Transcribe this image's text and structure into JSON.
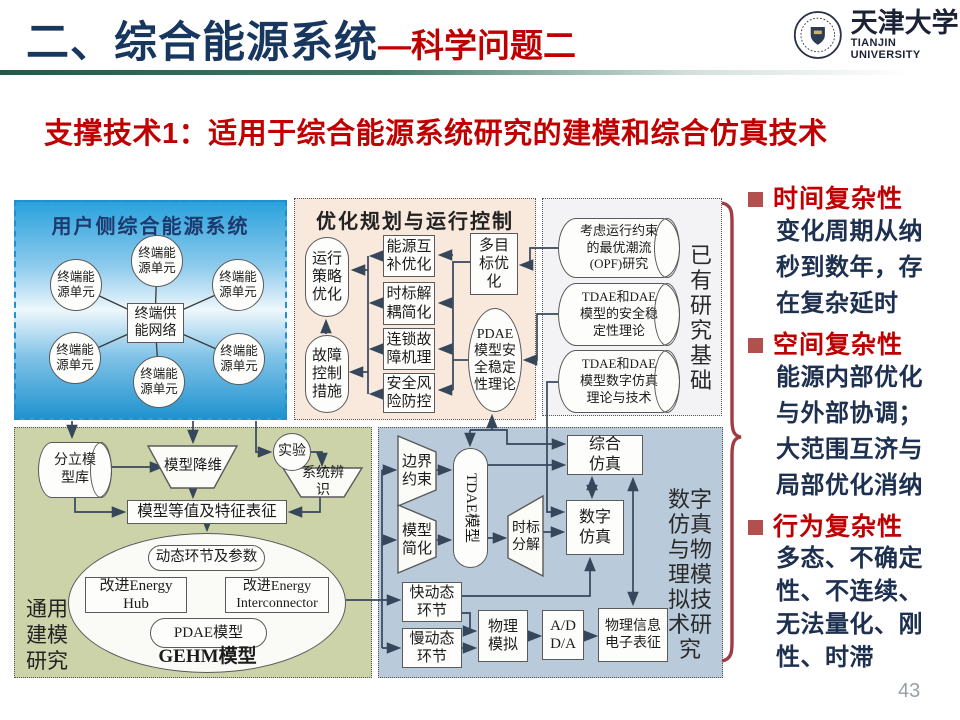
{
  "header": {
    "title": "二、综合能源系统",
    "subtitle_suffix": "—科学问题二",
    "logo_cn": "天津大学",
    "logo_en": "TIANJIN UNIVERSITY"
  },
  "lead": "支撑技术1：适用于综合能源系统研究的建模和综合仿真技术",
  "page_number": "43",
  "colors": {
    "title_navy": "#17375e",
    "accent_red": "#c00000",
    "sidebar_text": "#1e3050",
    "brace_red": "#a03c44",
    "panel_user_blue": "#2aa2dc",
    "panel_opt_pink": "#f9e8dc",
    "panel_exist_gray": "#f3f3f5",
    "panel_model_green": "#ccd3a9",
    "panel_sim_blue": "#b9cbdb"
  },
  "user_side": {
    "title": "用户侧综合能源系统",
    "hub": "终端供能网络",
    "unit": "终端能源单元"
  },
  "optimization": {
    "title": "优化规划与运行控制",
    "strategy": "运行策略优化",
    "fault": "故障控制措施",
    "complement": "能源互补优化",
    "timescale": "时标解耦简化",
    "cascade": "连锁故障机理",
    "risk": "安全风险防控",
    "multi_objective": "多目标优化",
    "pdae_theory": "PDAE模型安全稳定性理论"
  },
  "existing": {
    "side_label": "已有研究基础",
    "cyl1": [
      "考虑运行约束",
      "的最优潮流",
      "(OPF)研究"
    ],
    "cyl2": [
      "TDAE和DAE",
      "模型的安全稳",
      "定性理论"
    ],
    "cyl3": [
      "TDAE和DAE",
      "模型数字仿真",
      "理论与技术"
    ]
  },
  "modeling": {
    "side_label": "通用建模研究",
    "library": "分立模型库",
    "reduction": "模型降维",
    "experiment": "实验",
    "identification": "系统辨识",
    "equivalence": "模型等值及特征表征",
    "dynamics": "动态环节及参数",
    "hub": "改进Energy Hub",
    "interconnector": "改进Energy Interconnector",
    "pdae": "PDAE模型",
    "gehm": "GEHM模型"
  },
  "simulation": {
    "side_label": "数字仿真与物理模拟技术研究",
    "boundary": "边界约束",
    "simplification": "模型简化",
    "tdae": "TDAE模型",
    "decomposition": "时标分解",
    "digital": "数字仿真",
    "integrated": "综合仿真",
    "fast": "快动态环节",
    "slow": "慢动态环节",
    "physical": "物理模拟",
    "adda": "A/D D/A",
    "cyber": "物理信息电子表征"
  },
  "sidebar": {
    "sections": [
      {
        "heading": "时间复杂性",
        "lines": [
          "变化周期从纳",
          "秒到数年，存",
          "在复杂延时"
        ]
      },
      {
        "heading": "空间复杂性",
        "lines": [
          "能源内部优化",
          "与外部协调；",
          "大范围互济与",
          "局部优化消纳"
        ]
      },
      {
        "heading": "行为复杂性",
        "lines": [
          "多态、不确定",
          "性、不连续、",
          "无法量化、刚",
          "性、时滞"
        ]
      }
    ]
  }
}
